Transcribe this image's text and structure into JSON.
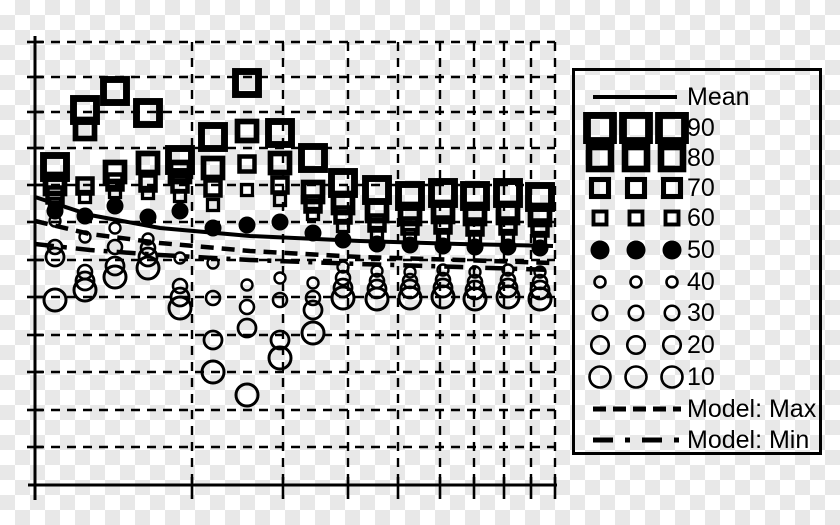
{
  "figure": {
    "background": {
      "checker_light": "#ffffff",
      "checker_dark": "#e8e8e8",
      "checker_size_px": 15
    },
    "ink_color": "#000000"
  },
  "chart_data": {
    "type": "scatter",
    "title": "",
    "xlabel": "",
    "ylabel": "",
    "x_axis": {
      "scale": "log",
      "left_px": 35,
      "right_px": 555,
      "baseline_px": 485,
      "gridlines_px": [
        192,
        283,
        348,
        398,
        440,
        474,
        504,
        531,
        555
      ],
      "grid_style": "dashed",
      "tick_labels": []
    },
    "y_axis": {
      "scale": "linear",
      "top_px": 36,
      "bottom_px": 500,
      "gridlines_px": [
        42,
        77,
        112,
        148,
        185,
        222,
        260,
        297,
        335,
        372,
        410,
        447
      ],
      "grid_style": "dashed",
      "tick_labels": []
    },
    "percentile_series": [
      "90",
      "80",
      "70",
      "60",
      "50",
      "40",
      "30",
      "20",
      "10"
    ],
    "marker_style": {
      "square_sizes_px": {
        "90": 23,
        "80": 19,
        "70": 15,
        "60": 11
      },
      "median_circle_r_px": 8.5,
      "circle_r_px": {
        "40": 5.5,
        "30": 7,
        "20": 9,
        "10": 11
      },
      "circle_stroke_px": {
        "40": 2.4,
        "30": 2.6,
        "20": 2.8,
        "10": 3
      }
    },
    "columns": [
      {
        "x": 55,
        "p90": 167,
        "p80": 184,
        "p70": 195,
        "p60": 204,
        "p50": 211,
        "p40": 221,
        "p30": 247,
        "p20": 257,
        "p10": 300
      },
      {
        "x": 85,
        "p90": 110,
        "p80": 129,
        "p70": 186,
        "p60": 197,
        "p50": 216,
        "p40": 237,
        "p30": 272,
        "p20": 281,
        "p10": 290
      },
      {
        "x": 115,
        "p90": 91,
        "p80": 172,
        "p70": 182,
        "p60": 192,
        "p50": 206,
        "p40": 228,
        "p30": 247,
        "p20": 266,
        "p10": 277
      },
      {
        "x": 148,
        "p90": 113,
        "p80": 163,
        "p70": 183,
        "p60": 193,
        "p50": 217,
        "p40": 239,
        "p30": 248,
        "p20": 257,
        "p10": 268
      },
      {
        "x": 180,
        "p90": 160,
        "p80": 172,
        "p70": 184,
        "p60": 196,
        "p50": 211,
        "p40": 258,
        "p30": 286,
        "p20": 297,
        "p10": 308
      },
      {
        "x": 213,
        "p90": 137,
        "p80": 168,
        "p70": 188,
        "p60": 205,
        "p50": 228,
        "p40": 263,
        "p30": 298,
        "p20": 340,
        "p10": 372
      },
      {
        "x": 247,
        "p90": 83,
        "p80": 131,
        "p70": 164,
        "p60": 190,
        "p50": 225,
        "p40": 285,
        "p30": 307,
        "p20": 328,
        "p10": 395
      },
      {
        "x": 280,
        "p90": 133,
        "p80": 163,
        "p70": 185,
        "p60": 200,
        "p50": 222,
        "p40": 278,
        "p30": 300,
        "p20": 340,
        "p10": 358
      },
      {
        "x": 313,
        "p90": 158,
        "p80": 192,
        "p70": 204,
        "p60": 214,
        "p50": 233,
        "p40": 283,
        "p30": 298,
        "p20": 310,
        "p10": 333
      },
      {
        "x": 343,
        "p90": 183,
        "p80": 203,
        "p70": 215,
        "p60": 226,
        "p50": 240,
        "p40": 267,
        "p30": 278,
        "p20": 288,
        "p10": 298
      },
      {
        "x": 377,
        "p90": 190,
        "p80": 211,
        "p70": 223,
        "p60": 233,
        "p50": 244,
        "p40": 271,
        "p30": 281,
        "p20": 289,
        "p10": 299
      },
      {
        "x": 410,
        "p90": 196,
        "p80": 214,
        "p70": 226,
        "p60": 235,
        "p50": 245,
        "p40": 272,
        "p30": 281,
        "p20": 289,
        "p10": 298
      },
      {
        "x": 443,
        "p90": 193,
        "p80": 212,
        "p70": 225,
        "p60": 235,
        "p50": 246,
        "p40": 270,
        "p30": 280,
        "p20": 288,
        "p10": 297
      },
      {
        "x": 475,
        "p90": 196,
        "p80": 214,
        "p70": 227,
        "p60": 237,
        "p50": 247,
        "p40": 272,
        "p30": 282,
        "p20": 290,
        "p10": 299
      },
      {
        "x": 508,
        "p90": 193,
        "p80": 213,
        "p70": 226,
        "p60": 236,
        "p50": 247,
        "p40": 270,
        "p30": 280,
        "p20": 288,
        "p10": 297
      },
      {
        "x": 540,
        "p90": 197,
        "p80": 215,
        "p70": 228,
        "p60": 238,
        "p50": 248,
        "p40": 272,
        "p30": 282,
        "p20": 290,
        "p10": 299
      }
    ],
    "lines": {
      "mean": {
        "style": "solid",
        "points_px": [
          [
            35,
            197
          ],
          [
            90,
            215
          ],
          [
            160,
            228
          ],
          [
            250,
            236
          ],
          [
            360,
            241
          ],
          [
            460,
            244
          ],
          [
            553,
            246
          ]
        ]
      },
      "model_max": {
        "style": "dashed",
        "points_px": [
          [
            35,
            221
          ],
          [
            90,
            234
          ],
          [
            160,
            243
          ],
          [
            250,
            251
          ],
          [
            360,
            257
          ],
          [
            460,
            260
          ],
          [
            553,
            263
          ]
        ]
      },
      "model_min": {
        "style": "dashdot",
        "points_px": [
          [
            35,
            244
          ],
          [
            90,
            250
          ],
          [
            160,
            255
          ],
          [
            250,
            260
          ],
          [
            360,
            264
          ],
          [
            460,
            267
          ],
          [
            553,
            270
          ]
        ]
      }
    }
  },
  "legend": {
    "items": [
      {
        "label": "Mean",
        "kind": "line-solid"
      },
      {
        "label": "90",
        "kind": "square",
        "size": 26
      },
      {
        "label": "80",
        "kind": "square",
        "size": 22
      },
      {
        "label": "70",
        "kind": "square",
        "size": 17
      },
      {
        "label": "60",
        "kind": "square",
        "size": 13
      },
      {
        "label": "50",
        "kind": "circle-filled",
        "size": 19
      },
      {
        "label": "40",
        "kind": "circle",
        "size": 11
      },
      {
        "label": "30",
        "kind": "circle",
        "size": 14.5
      },
      {
        "label": "20",
        "kind": "circle",
        "size": 17.5
      },
      {
        "label": "10",
        "kind": "circle",
        "size": 21
      },
      {
        "label": "Model: Max",
        "kind": "line-dashed"
      },
      {
        "label": "Model: Min",
        "kind": "line-dashdot"
      }
    ],
    "row_y_px": [
      10,
      41,
      71,
      101,
      131,
      163,
      195,
      226,
      258,
      290,
      322,
      353
    ]
  }
}
